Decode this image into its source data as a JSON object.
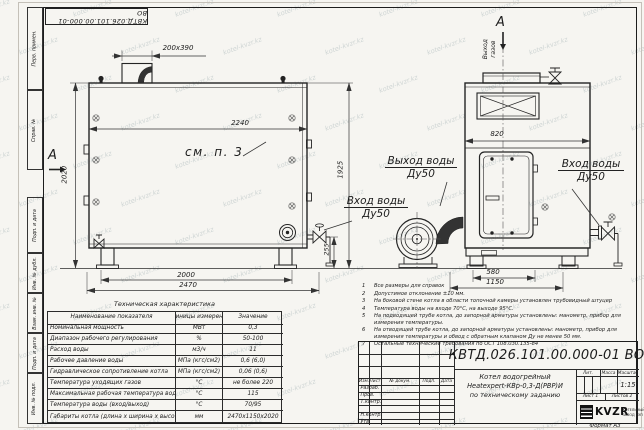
{
  "watermark": {
    "text": "kotel-kvzr.kz"
  },
  "stamp_top": "КВТД.026.101.00.000-01 ВО",
  "frame_labels": {
    "perv_primen": "Перв. примен.",
    "sprav_no": "Справ. №",
    "podp_data1": "Подп. и дата",
    "inv_dubl": "Инв. № дубл.",
    "vzam_inv": "Взам. инв. №",
    "podp_data2": "Подп. и дата",
    "inv_podl": "Инв. № подл."
  },
  "drawing": {
    "section_label_left": "А",
    "section_label_top": "А",
    "gas_outlet_line1": "Выход",
    "gas_outlet_line2": "газов",
    "see_note": "см. п. 3",
    "labels": {
      "water_outlet_line1": "Выход воды",
      "water_outlet_line2": "Ду50",
      "water_inlet_left_line1": "Вход воды",
      "water_inlet_left_line2": "Ду50",
      "water_inlet_right_line1": "Вход воды",
      "water_inlet_right_line2": "Ду50"
    },
    "dims": {
      "duct": "200х390",
      "front_width": "2240",
      "front_height": "2020",
      "body_height": "1925",
      "base_span": "2000",
      "overall_length": "2470",
      "pump_height": "255",
      "side_width": "820",
      "side_base": "580",
      "side_overall": "1150"
    }
  },
  "tech_table": {
    "title": "Техническая характеристика",
    "headers": [
      "Наименование показателя",
      "Единицы измерения",
      "Значение"
    ],
    "rows": [
      {
        "name": "Номинальная мощность",
        "unit": "МВт",
        "value": "0,3"
      },
      {
        "name": "Диапазон рабочего регулирования",
        "unit": "%",
        "value": "50-100"
      },
      {
        "name": "Расход воды",
        "unit": "м3/ч",
        "value": "11"
      },
      {
        "name": "Рабочее давление воды",
        "unit": "МПа (кгс/см2)",
        "value": "0,6 (6,0)"
      },
      {
        "name": "Гидравлическое сопротивление котла",
        "unit": "МПа (кгс/см2)",
        "value": "0,06 (0,6)"
      },
      {
        "name": "Температура уходящих газов",
        "unit": "°С",
        "value": "не более 220"
      },
      {
        "name": "Максимальная рабочая температура воды",
        "unit": "°С",
        "value": "115"
      },
      {
        "name": "Температура воды (вход/выход)",
        "unit": "°С",
        "value": "70/95"
      },
      {
        "name": "Габариты котла (длина х ширина х высота)",
        "unit": "мм",
        "value": "2470х1150х2020"
      }
    ]
  },
  "notes": [
    {
      "num": "1",
      "text": "Все размеры для справок"
    },
    {
      "num": "2",
      "text": "Допустимое отклонение ±10 мм."
    },
    {
      "num": "3",
      "text": "На боковой стене котла в области топочной камеры установлен трубовидный штуцер"
    },
    {
      "num": "4",
      "text": "Температура воды на входе 70°С, на выходе 95°С."
    },
    {
      "num": "5",
      "text": "На подводящей трубе котла, до запорной арматуры установлены: манометр, прибор для измерения температуры."
    },
    {
      "num": "6",
      "text": "На отводящей трубе котла, до запорной арматуры установлены: манометр, прибор для измерения температуры и обвод с обратным клапаном Ду не менее 50 мм."
    },
    {
      "num": "7",
      "text": "Остальные технические требования по ОСТ 108.030.135-84"
    }
  ],
  "title_block": {
    "doc_number": "КВТД.026.101.00.000-01  ВО",
    "name_line1": "Котел водогрейный",
    "name_line2": "Heatexpert-КВр-0,3-Д(РВР)И",
    "name_line3": "по техническому заданию",
    "col_izm": "Изм.",
    "col_list": "Лист",
    "col_doc": "№ докум.",
    "col_podp": "Подп.",
    "col_data": "Дата",
    "row_razrab": "Разраб.",
    "row_prov": "Пров.",
    "row_tkontr": "Т.контр.",
    "row_nkontr": "Н.контр.",
    "row_utv": "Утв.",
    "lit_label": "Лит.",
    "mass_label": "Масса",
    "scale_label": "Масштаб",
    "scale_value": "1:15",
    "sheet_label": "Лист",
    "sheet_value": "1",
    "sheets_label": "Листов",
    "sheets_value": "2",
    "org_abbr": "KVZR",
    "org_line1": "КОТЕЛЬНЫЙ",
    "org_line2": "ЗАВОД РЭП",
    "format_label": "Формат",
    "format_value": "А3"
  }
}
